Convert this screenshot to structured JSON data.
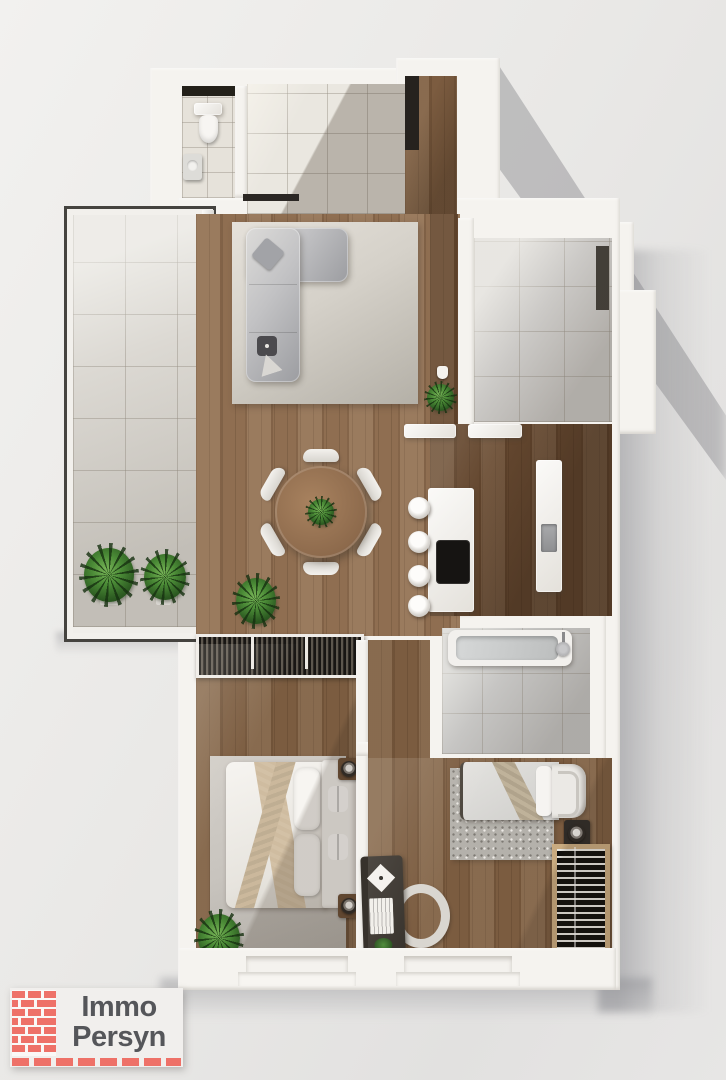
{
  "logo": {
    "line1": "Immo",
    "line2": "Persyn"
  },
  "colors": {
    "bg-light": "#f2f1ef",
    "bg-mid": "#e9e8e6",
    "wall": "#f5f3ef",
    "wood-living": "#8f6e51",
    "wood-corridor": "#7c5c40",
    "wood-dark": "#64472f",
    "wood-bedroom": "#7b5c40",
    "tile-balcony": "#dcd9d3",
    "tile-entry": "#eae7e0",
    "tile-wc": "#e6e2da",
    "tile-bath": "#c6c5c3",
    "tile-topright": "#cbc9c6",
    "rug-living-a": "#e5e1da",
    "rug-living-b": "#b4b0a7",
    "rug-bedroom": "#c8c4be",
    "rug-speckle": "#b4b1ab",
    "sofa-a": "#dcdbd9",
    "sofa-b": "#9c9da1",
    "bed-white": "#f2f0ec",
    "throw-beige": "#cfbca0",
    "furniture-dark": "#37322c",
    "appliance-black": "#161412",
    "steel": "#9a9a9c",
    "plant-green": "#4a8a36",
    "logo-red": "#ee7168",
    "logo-text": "#55565a",
    "logo-bg": "#f1efed"
  },
  "rooms": [
    "entrance-hall",
    "wc",
    "corridor",
    "balcony-terrace",
    "living-room",
    "dining-area",
    "kitchen",
    "storage-room",
    "bathroom",
    "hallway",
    "master-bedroom",
    "second-bedroom"
  ],
  "depicted_objects": [
    "toilet",
    "washbasin",
    "l-shaped-sofa",
    "cushions",
    "side-table",
    "area-rug",
    "round-dining-table",
    "dining-chairs",
    "potted-plants",
    "kitchen-island",
    "cooktop",
    "bar-stools",
    "counter-with-sink",
    "bathtub",
    "shower-head",
    "slatted-wardrobe",
    "double-bed",
    "single-bed",
    "nightstands",
    "lamps",
    "desk",
    "desk-chair",
    "radiator",
    "window-sills",
    "wall-lamp"
  ]
}
